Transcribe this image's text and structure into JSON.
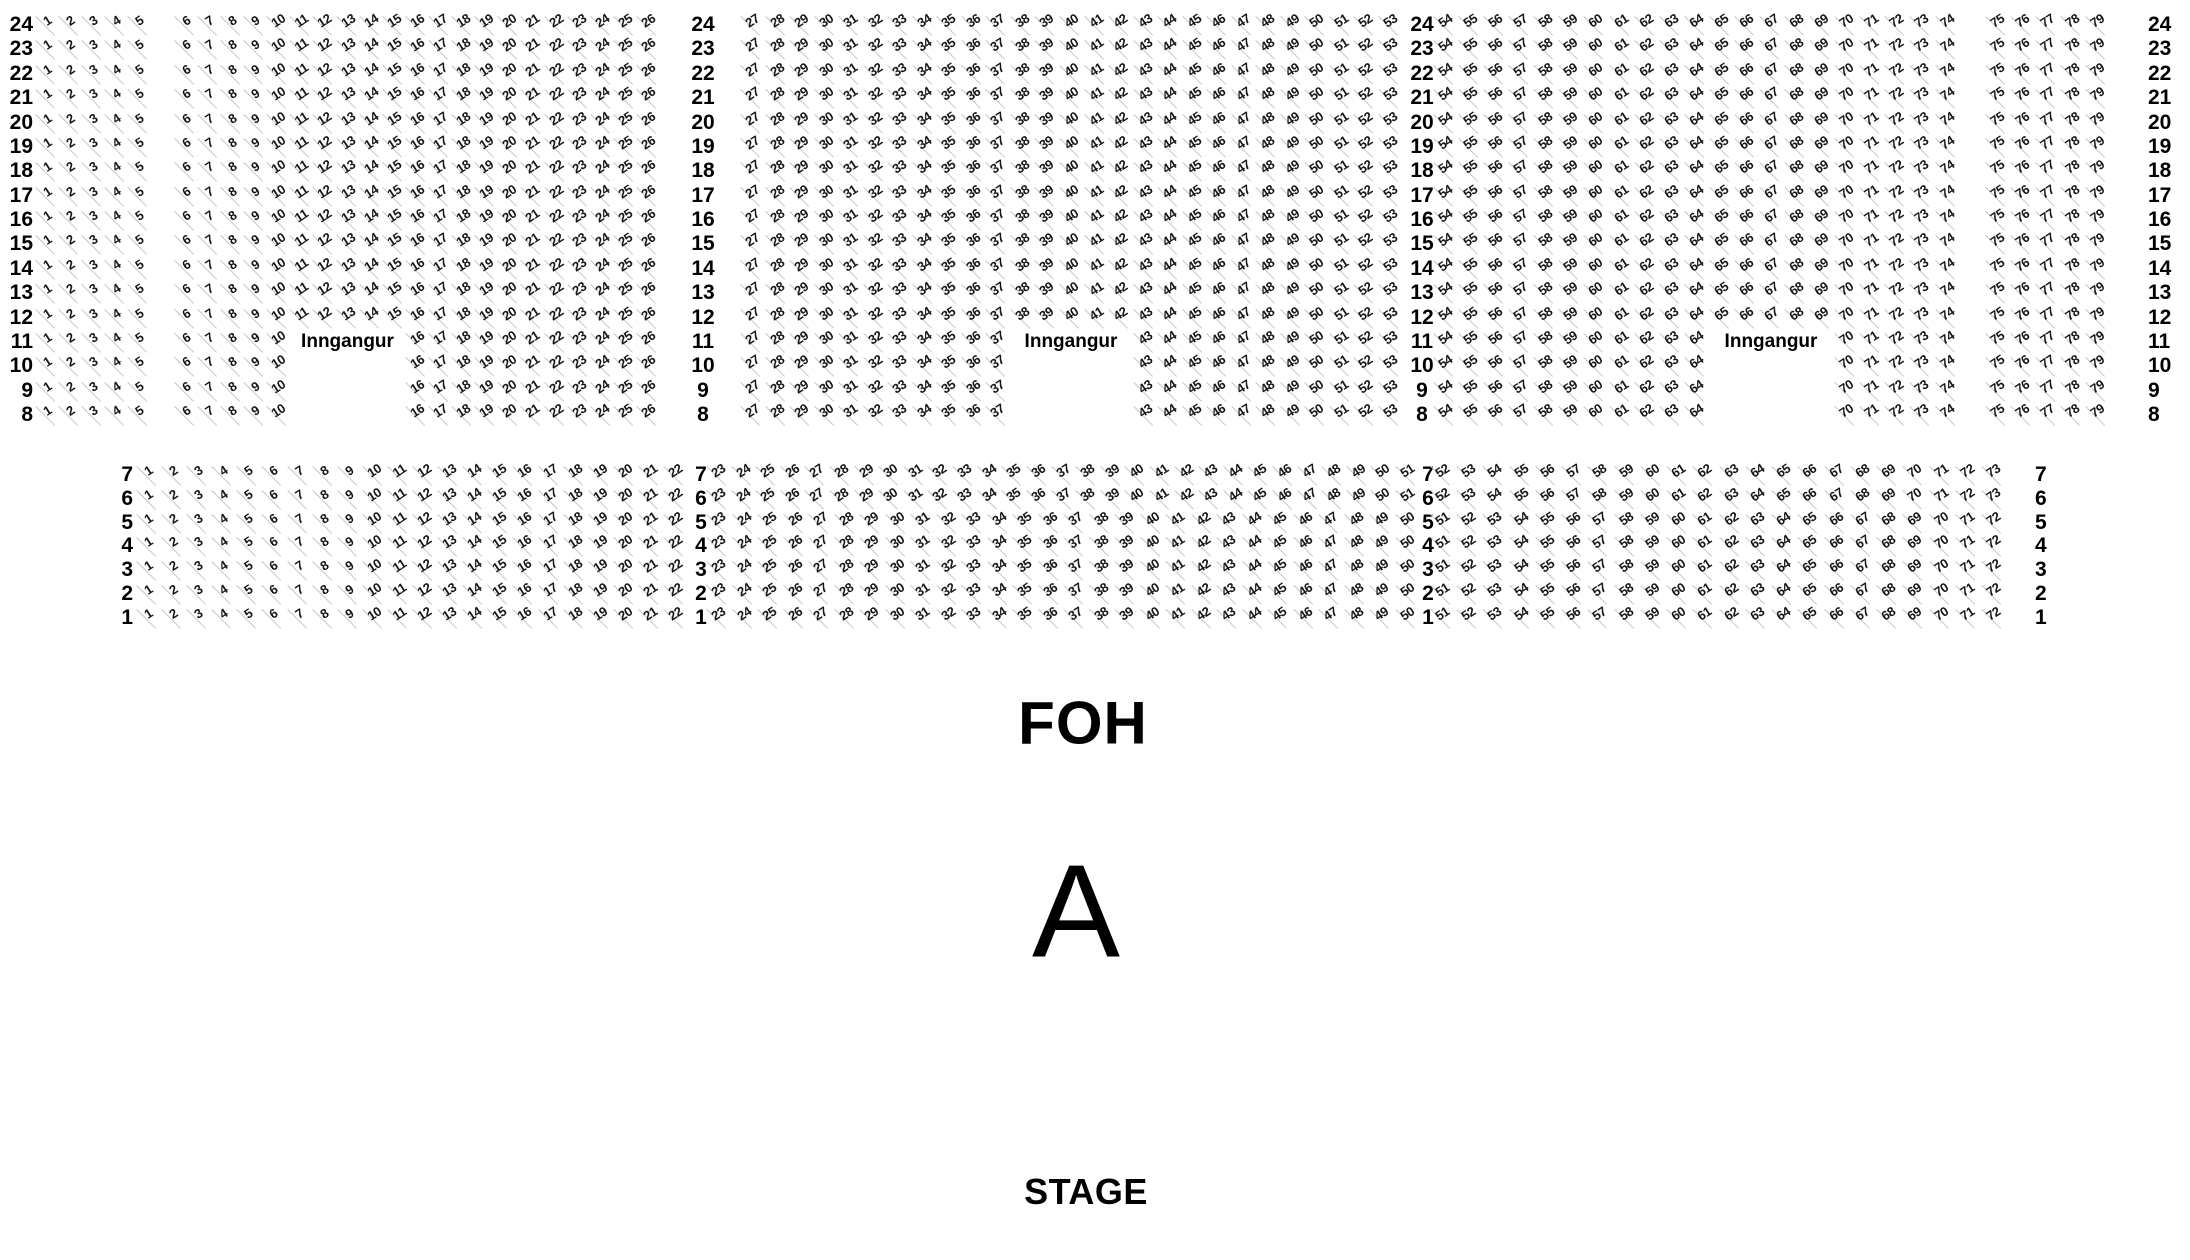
{
  "texts": {
    "foh": "FOH",
    "section_letter": "A",
    "stage": "STAGE",
    "entrance": "Inngangur"
  },
  "colors": {
    "background": "#ffffff",
    "seat_number": "#161616",
    "row_label": "#000000",
    "seat_line": "#c6c6c6",
    "big_text": "#000000"
  },
  "seat_map": {
    "blocks": [
      {
        "name": "rear-block",
        "rows": [
          24,
          23,
          22,
          21,
          20,
          19,
          18,
          17,
          16,
          15,
          14,
          13,
          12,
          11,
          10,
          9,
          8
        ],
        "first_row_y": 25,
        "row_pitch": 24.375,
        "entrance_row": 11,
        "label_columns": [
          {
            "x": 33,
            "align": "right"
          },
          {
            "x": 703,
            "align": "center"
          },
          {
            "x": 1422,
            "align": "center"
          },
          {
            "x": 2148,
            "align": "left"
          }
        ],
        "sections": [
          {
            "x_start": 47,
            "x_end": 648,
            "aisle_after": 5,
            "ranges": [
              {
                "rows": "all",
                "from": 1,
                "to": 26
              }
            ],
            "entrance_gap": {
              "rows": [
                11,
                10,
                9,
                8
              ],
              "from": 11,
              "to": 15
            }
          },
          {
            "x_start": 752,
            "x_end": 1390,
            "ranges": [
              {
                "rows": "all",
                "from": 27,
                "to": 53
              }
            ],
            "entrance_gap": {
              "rows": [
                11,
                10,
                9,
                8
              ],
              "from": 38,
              "to": 42
            }
          },
          {
            "x_start": 1445,
            "x_end": 2097,
            "aisle_after": 74,
            "ranges": [
              {
                "rows": "all",
                "from": 54,
                "to": 79
              }
            ],
            "entrance_gap": {
              "rows": [
                11,
                10,
                9,
                8
              ],
              "from": 65,
              "to": 69
            }
          }
        ]
      },
      {
        "name": "front-block",
        "rows": [
          7,
          6,
          5,
          4,
          3,
          2,
          1
        ],
        "first_row_y": 475,
        "row_pitch": 23.83,
        "label_columns": [
          {
            "x": 133,
            "align": "right"
          },
          {
            "x": 701,
            "align": "center"
          },
          {
            "x": 1428,
            "align": "center"
          },
          {
            "x": 2035,
            "align": "left"
          }
        ],
        "sections": [
          {
            "x_start": 148,
            "x_end": 675,
            "ranges": [
              {
                "rows": "all",
                "from": 1,
                "to": 22
              }
            ]
          },
          {
            "x_start": 718,
            "x_end": 1407,
            "ranges": [
              {
                "rows": [
                  7,
                  6
                ],
                "from": 23,
                "to": 51
              },
              {
                "rows": [
                  5,
                  4,
                  3,
                  2,
                  1
                ],
                "from": 23,
                "to": 50
              }
            ]
          },
          {
            "x_start": 1442,
            "x_end": 1993,
            "ranges": [
              {
                "rows": [
                  7,
                  6
                ],
                "from": 52,
                "to": 73
              },
              {
                "rows": [
                  5,
                  4,
                  3,
                  2,
                  1
                ],
                "from": 51,
                "to": 72
              }
            ]
          }
        ]
      }
    ]
  }
}
